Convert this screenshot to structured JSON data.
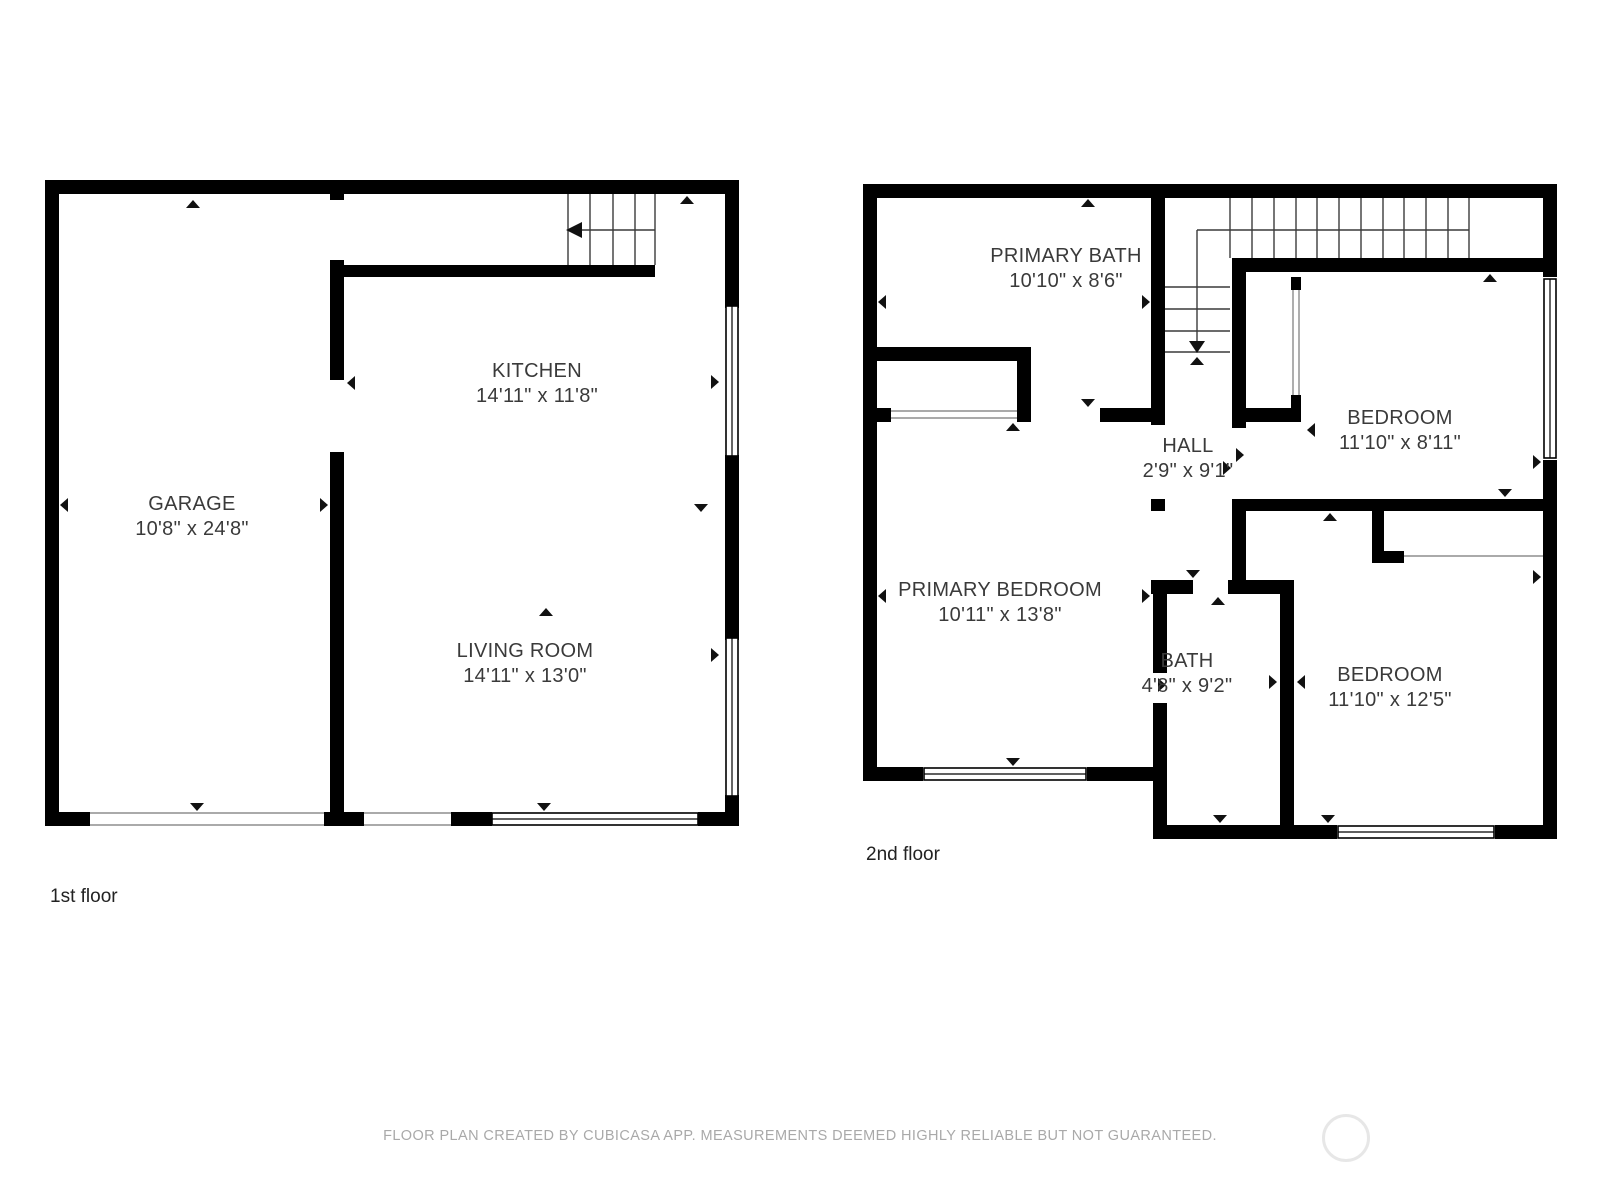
{
  "floors": [
    {
      "label": "1st floor",
      "rooms": [
        {
          "name": "GARAGE",
          "dims": "10'8\" x 24'8\""
        },
        {
          "name": "KITCHEN",
          "dims": "14'11\" x 11'8\""
        },
        {
          "name": "LIVING ROOM",
          "dims": "14'11\" x 13'0\""
        }
      ]
    },
    {
      "label": "2nd floor",
      "rooms": [
        {
          "name": "PRIMARY BATH",
          "dims": "10'10\" x 8'6\""
        },
        {
          "name": "HALL",
          "dims": "2'9\" x 9'1\""
        },
        {
          "name": "BEDROOM",
          "dims": "11'10\" x 8'11\""
        },
        {
          "name": "PRIMARY BEDROOM",
          "dims": "10'11\" x 13'8\""
        },
        {
          "name": "BATH",
          "dims": "4'8\" x 9'2\""
        },
        {
          "name": "BEDROOM",
          "dims": "11'10\" x 12'5\""
        }
      ]
    }
  ],
  "footer": {
    "disclaimer": "FLOOR PLAN CREATED BY CUBICASA APP. MEASUREMENTS DEEMED HIGHLY RELIABLE BUT NOT GUARANTEED."
  }
}
